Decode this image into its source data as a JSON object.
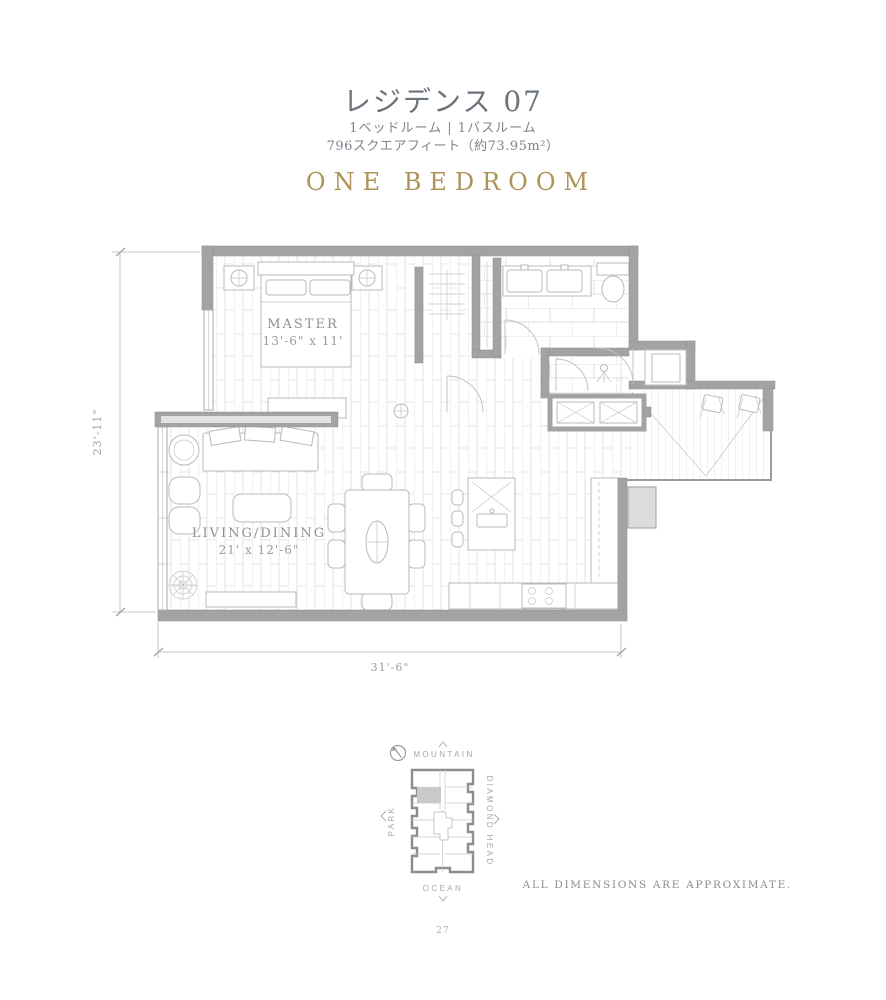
{
  "header": {
    "title": "レジデンス 07",
    "subtitle_line1": "1ベッドルーム | 1バスルーム",
    "subtitle_line2": "796スクエアフィート（約73.95m²）",
    "plan_type": "ONE BEDROOM"
  },
  "floorplan": {
    "master": {
      "label": "MASTER",
      "dims": "13'-6\" x 11'"
    },
    "living_dining": {
      "label": "LIVING/DINING",
      "dims": "21' x 12'-6\""
    },
    "dimension_left": "23'-11\"",
    "dimension_bottom": "31'-6\""
  },
  "key_plan": {
    "direction_top": "MOUNTAIN",
    "direction_bottom": "OCEAN",
    "direction_left": "PARK",
    "direction_right": "DIAMOND HEAD"
  },
  "footer": {
    "disclaimer": "ALL DIMENSIONS ARE APPROXIMATE.",
    "page_number": "27"
  },
  "colors": {
    "accent_gold": "#ad9355",
    "title_gray": "#6b747d",
    "wall_gray": "#a3a3a3",
    "line_gray": "#b7babc",
    "unit_highlight": "#c9c9c9"
  }
}
